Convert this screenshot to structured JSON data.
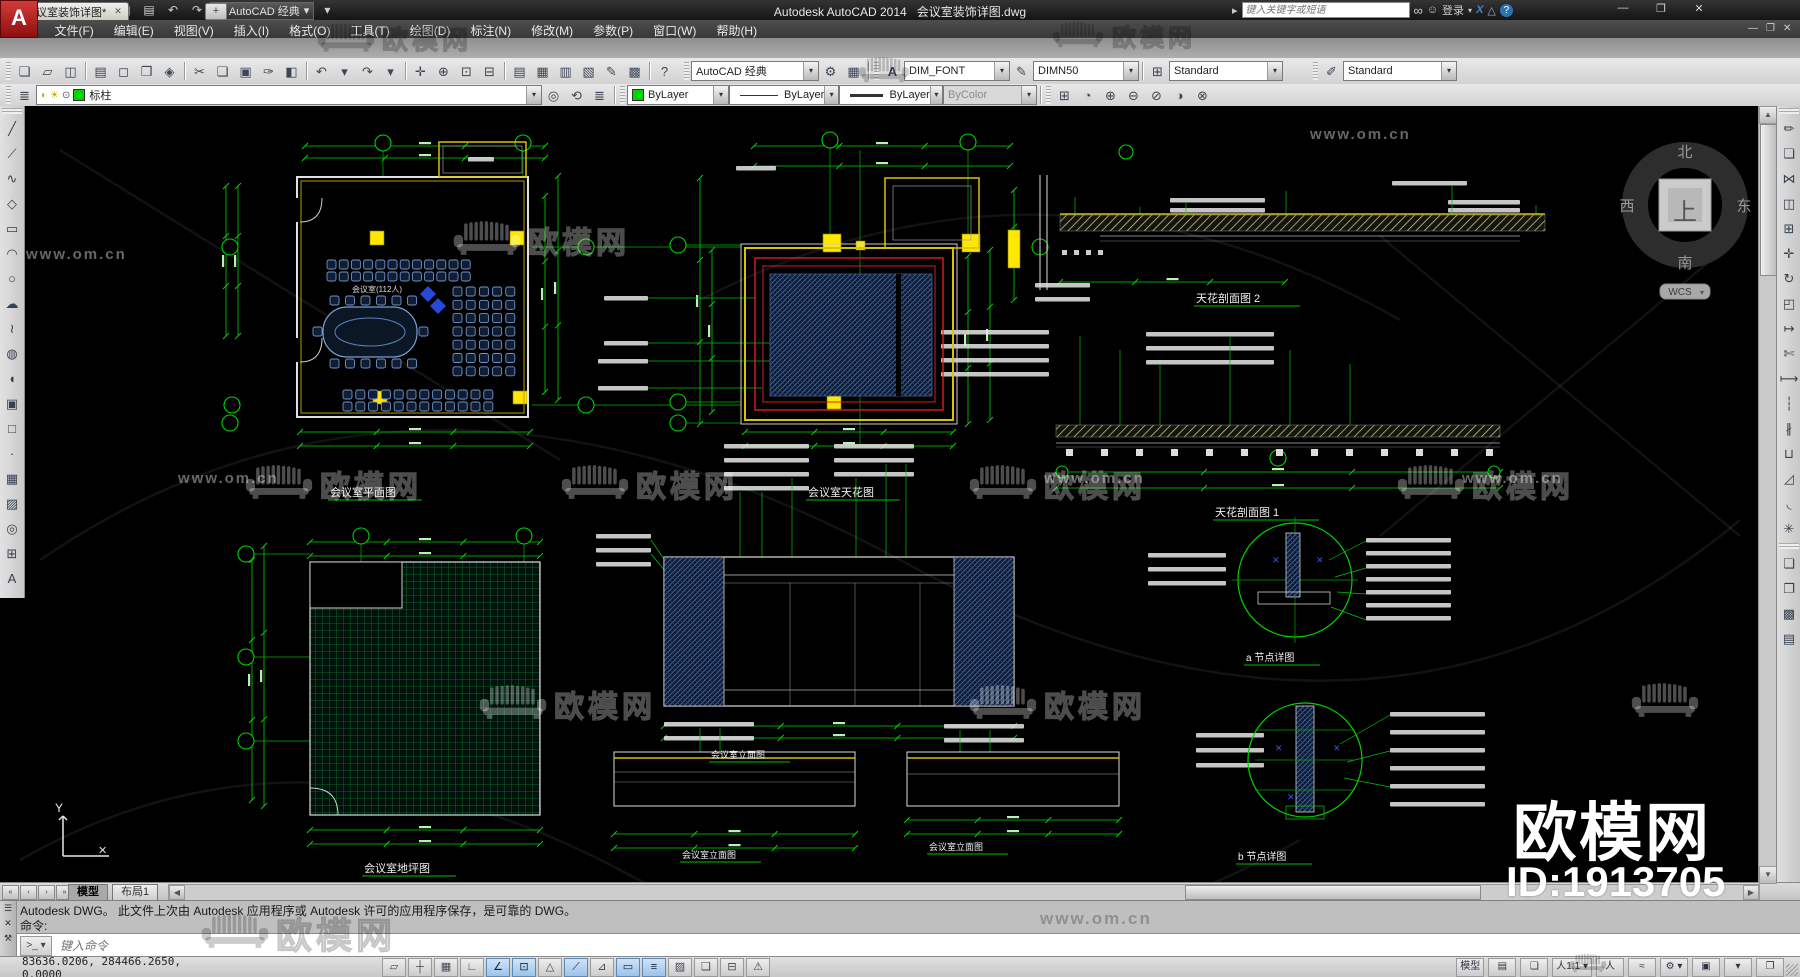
{
  "window": {
    "app_title": "Autodesk AutoCAD 2014",
    "doc_title": "会议室装饰详图.dwg",
    "controls": {
      "min": "—",
      "restore": "❐",
      "close": "✕"
    },
    "doc_controls": {
      "min": "—",
      "restore": "❐",
      "close": "✕"
    }
  },
  "menu": {
    "items": [
      {
        "name": "menu-file",
        "label": "文件(F)"
      },
      {
        "name": "menu-edit",
        "label": "编辑(E)"
      },
      {
        "name": "menu-view",
        "label": "视图(V)"
      },
      {
        "name": "menu-insert",
        "label": "插入(I)"
      },
      {
        "name": "menu-format",
        "label": "格式(O)"
      },
      {
        "name": "menu-tools",
        "label": "工具(T)"
      },
      {
        "name": "menu-draw",
        "label": "绘图(D)"
      },
      {
        "name": "menu-dimension",
        "label": "标注(N)"
      },
      {
        "name": "menu-modify",
        "label": "修改(M)"
      },
      {
        "name": "menu-parametric",
        "label": "参数(P)"
      },
      {
        "name": "menu-window",
        "label": "窗口(W)"
      },
      {
        "name": "menu-help",
        "label": "帮助(H)"
      }
    ]
  },
  "qat": {
    "icons": [
      {
        "name": "qnew-icon",
        "glyph": "❏"
      },
      {
        "name": "open-icon",
        "glyph": "▱"
      },
      {
        "name": "save-icon",
        "glyph": "◫"
      },
      {
        "name": "saveas-icon",
        "glyph": "◪"
      },
      {
        "name": "plot-icon",
        "glyph": "▤"
      },
      {
        "name": "undo-icon",
        "glyph": "↶"
      },
      {
        "name": "redo-icon",
        "glyph": "↷"
      }
    ],
    "workspace": "AutoCAD 经典",
    "gear": "⚙",
    "menu_arrow": "▾"
  },
  "infocenter": {
    "arrow": "▸",
    "placeholder": "键入关键字或短语",
    "search_icon": "∞",
    "signin_icon": "☺",
    "signin": "登录",
    "exchange_icon": "X",
    "a360_icon": "△",
    "help_icon": "?"
  },
  "filetabs": {
    "tab_label": "会议室装饰详图*",
    "close": "✕",
    "new_tab": "+"
  },
  "toolbars": {
    "standard": [
      {
        "name": "qnew-icon",
        "glyph": "❏"
      },
      {
        "name": "open-icon",
        "glyph": "▱"
      },
      {
        "name": "save-icon",
        "glyph": "◫"
      },
      {
        "name": "separator",
        "sep": true
      },
      {
        "name": "plot-icon",
        "glyph": "▤"
      },
      {
        "name": "plot-preview-icon",
        "glyph": "◻"
      },
      {
        "name": "publish-icon",
        "glyph": "❒"
      },
      {
        "name": "etransmit-icon",
        "glyph": "◈"
      },
      {
        "name": "separator",
        "sep": true
      },
      {
        "name": "cut-icon",
        "glyph": "✂"
      },
      {
        "name": "copy-clip-icon",
        "glyph": "❏"
      },
      {
        "name": "paste-icon",
        "glyph": "▣"
      },
      {
        "name": "match-properties-icon",
        "glyph": "✑"
      },
      {
        "name": "block-editor-icon",
        "glyph": "◧"
      },
      {
        "name": "separator",
        "sep": true
      },
      {
        "name": "undo-icon",
        "glyph": "↶"
      },
      {
        "name": "undo-arrow-icon",
        "glyph": "▾"
      },
      {
        "name": "redo-icon",
        "glyph": "↷"
      },
      {
        "name": "redo-arrow-icon",
        "glyph": "▾"
      },
      {
        "name": "separator",
        "sep": true
      },
      {
        "name": "pan-icon",
        "glyph": "✛"
      },
      {
        "name": "zoom-realtime-icon",
        "glyph": "⊕"
      },
      {
        "name": "zoom-window-icon",
        "glyph": "⊡"
      },
      {
        "name": "zoom-previous-icon",
        "glyph": "⊟"
      },
      {
        "name": "separator",
        "sep": true
      },
      {
        "name": "properties-icon",
        "glyph": "▤"
      },
      {
        "name": "designcenter-icon",
        "glyph": "▦"
      },
      {
        "name": "tool-palettes-icon",
        "glyph": "▥"
      },
      {
        "name": "sheet-set-icon",
        "glyph": "▧"
      },
      {
        "name": "markup-icon",
        "glyph": "✎"
      },
      {
        "name": "quickcalc-icon",
        "glyph": "▩"
      },
      {
        "name": "separator",
        "sep": true
      },
      {
        "name": "help-icon",
        "glyph": "?"
      }
    ],
    "workspace_label": "AutoCAD 经典",
    "ws_gear_icon": "⚙",
    "ws_monitor_icon": "▦",
    "styles": {
      "text_style_icon": "A",
      "text_style": "DIM_FONT",
      "dim_style_icon": "✎",
      "dim_style": "DIMN50",
      "table_style_icon": "⊞",
      "table_style": "Standard",
      "mleader_style_icon": "✐",
      "mleader_style": "Standard"
    },
    "layers": {
      "panel_icon": "≣",
      "bulb_icon": "◐",
      "sun_icon": "☀",
      "lock_icon": "⊙",
      "current": "标柱",
      "tools": [
        {
          "name": "make-object-layer-current-icon",
          "glyph": "◎"
        },
        {
          "name": "layer-previous-icon",
          "glyph": "⟲"
        },
        {
          "name": "layer-states-icon",
          "glyph": "≣"
        }
      ]
    },
    "properties": {
      "color": "ByLayer",
      "linetype": "ByLayer",
      "lineweight": "ByLayer",
      "plotstyle": "ByColor"
    },
    "viewports": [
      {
        "name": "named-views-icon",
        "glyph": "⊞"
      },
      {
        "name": "vp-single-icon",
        "glyph": "◔"
      },
      {
        "name": "vp-add-icon",
        "glyph": "⊕"
      },
      {
        "name": "vp-remove-icon",
        "glyph": "⊖"
      },
      {
        "name": "vp-clip-icon",
        "glyph": "⊘"
      },
      {
        "name": "vp-shade-icon",
        "glyph": "◑"
      },
      {
        "name": "vp-delete-icon",
        "glyph": "⊗"
      }
    ]
  },
  "draw_toolbar": [
    {
      "name": "line-icon",
      "glyph": "╱"
    },
    {
      "name": "construction-line-icon",
      "glyph": "⟋"
    },
    {
      "name": "polyline-icon",
      "glyph": "∿"
    },
    {
      "name": "polygon-icon",
      "glyph": "◇"
    },
    {
      "name": "rectangle-icon",
      "glyph": "▭"
    },
    {
      "name": "arc-icon",
      "glyph": "◠"
    },
    {
      "name": "circle-icon",
      "glyph": "○"
    },
    {
      "name": "revcloud-icon",
      "glyph": "☁"
    },
    {
      "name": "spline-icon",
      "glyph": "≀"
    },
    {
      "name": "ellipse-icon",
      "glyph": "◍"
    },
    {
      "name": "ellipse-arc-icon",
      "glyph": "◖"
    },
    {
      "name": "insert-block-icon",
      "glyph": "▣"
    },
    {
      "name": "make-block-icon",
      "glyph": "□"
    },
    {
      "name": "point-icon",
      "glyph": "·"
    },
    {
      "name": "hatch-icon",
      "glyph": "▦"
    },
    {
      "name": "gradient-icon",
      "glyph": "▨"
    },
    {
      "name": "region-icon",
      "glyph": "◎"
    },
    {
      "name": "table-icon",
      "glyph": "⊞"
    },
    {
      "name": "mtext-icon",
      "glyph": "A"
    }
  ],
  "modify_toolbar": [
    {
      "name": "erase-icon",
      "glyph": "✏"
    },
    {
      "name": "copy-icon",
      "glyph": "❏"
    },
    {
      "name": "mirror-icon",
      "glyph": "⋈"
    },
    {
      "name": "offset-icon",
      "glyph": "◫"
    },
    {
      "name": "array-icon",
      "glyph": "⊞"
    },
    {
      "name": "move-icon",
      "glyph": "✛"
    },
    {
      "name": "rotate-icon",
      "glyph": "↻"
    },
    {
      "name": "scale-icon",
      "glyph": "◰"
    },
    {
      "name": "stretch-icon",
      "glyph": "↦"
    },
    {
      "name": "trim-icon",
      "glyph": "✄"
    },
    {
      "name": "extend-icon",
      "glyph": "⟼"
    },
    {
      "name": "break-point-icon",
      "glyph": "┆"
    },
    {
      "name": "break-icon",
      "glyph": "∦"
    },
    {
      "name": "join-icon",
      "glyph": "⊔"
    },
    {
      "name": "chamfer-icon",
      "glyph": "◿"
    },
    {
      "name": "fillet-icon",
      "glyph": "◟"
    },
    {
      "name": "explode-icon",
      "glyph": "✳"
    }
  ],
  "draworder_toolbar": [
    {
      "name": "bring-front-icon",
      "glyph": "❏"
    },
    {
      "name": "send-back-icon",
      "glyph": "❐"
    },
    {
      "name": "bring-above-icon",
      "glyph": "▩"
    },
    {
      "name": "send-under-icon",
      "glyph": "▤"
    }
  ],
  "canvas": {
    "titles": {
      "plan": "会议室平面图",
      "ceiling": "会议室天花图",
      "floor": "会议室地坪图",
      "section2": "天花剖面图  2",
      "section1": "天花剖面图  1",
      "detail_a": "a 节点详图",
      "detail_b": "b 节点详图",
      "elev_main": "会议室立面图",
      "elev_left": "会议室立面图",
      "elev_right": "会议室立面图"
    },
    "room_label": "会议室(112人)",
    "viewcube": {
      "north": "北",
      "south": "南",
      "east": "东",
      "west": "西",
      "top": "上",
      "wcs": "WCS"
    },
    "ucs_y": "Y",
    "cross": "✕",
    "watermark": {
      "brand": "欧模网",
      "url": "www.om.cn",
      "id": "ID:1913705"
    }
  },
  "cmdline": {
    "history_line": "Autodesk DWG。  此文件上次由 Autodesk 应用程序或 Autodesk 许可的应用程序保存，是可靠的 DWG。",
    "prompt": "命令:",
    "input_placeholder": "键入命令",
    "grip": "☰",
    "close": "✕",
    "customize": "⚒",
    "prompt_btn": ">_ ▾"
  },
  "tabsrow": {
    "nav": [
      {
        "name": "first-tab-icon",
        "glyph": "«"
      },
      {
        "name": "prev-tab-icon",
        "glyph": "‹"
      },
      {
        "name": "next-tab-icon",
        "glyph": "›"
      },
      {
        "name": "last-tab-icon",
        "glyph": "»"
      }
    ],
    "model": "模型",
    "layout1": "布局1"
  },
  "statusbar": {
    "coords": "83636.0206, 284466.2650, 0.0000",
    "toggles": [
      {
        "name": "infer-constraints-toggle",
        "glyph": "▱",
        "active": false
      },
      {
        "name": "snap-toggle",
        "glyph": "┼",
        "active": false
      },
      {
        "name": "grid-toggle",
        "glyph": "▦",
        "active": false
      },
      {
        "name": "ortho-toggle",
        "glyph": "∟",
        "active": false
      },
      {
        "name": "polar-toggle",
        "glyph": "∠",
        "active": true
      },
      {
        "name": "osnap-toggle",
        "glyph": "⊡",
        "active": true
      },
      {
        "name": "osnap3d-toggle",
        "glyph": "△",
        "active": false
      },
      {
        "name": "otrack-toggle",
        "glyph": "⟋",
        "active": true
      },
      {
        "name": "ducs-toggle",
        "glyph": "⊿",
        "active": false
      },
      {
        "name": "dyn-toggle",
        "glyph": "▭",
        "active": true
      },
      {
        "name": "lwt-toggle",
        "glyph": "≡",
        "active": true
      },
      {
        "name": "transparency-toggle",
        "glyph": "▨",
        "active": false
      },
      {
        "name": "quick-properties-toggle",
        "glyph": "❑",
        "active": false
      },
      {
        "name": "selection-cycling-toggle",
        "glyph": "⊟",
        "active": false
      },
      {
        "name": "annotation-monitor-toggle",
        "glyph": "⚠",
        "active": false
      }
    ],
    "right_items": [
      {
        "name": "model-space-button",
        "label": "模型"
      },
      {
        "name": "quick-view-layouts-icon",
        "glyph": "▤"
      },
      {
        "name": "quick-view-drawings-icon",
        "glyph": "❏"
      },
      {
        "name": "annotation-scale-button",
        "label": "人1:1 ▾"
      },
      {
        "name": "annotation-visibility-icon",
        "glyph": "人"
      },
      {
        "name": "autoscale-icon",
        "glyph": "≈"
      },
      {
        "name": "workspace-switch-icon",
        "glyph": "⚙ ▾"
      },
      {
        "name": "toolbar-lock-icon",
        "glyph": "▣"
      },
      {
        "name": "tray-icon",
        "glyph": "▾"
      },
      {
        "name": "clean-screen-icon",
        "glyph": "❐"
      }
    ]
  }
}
